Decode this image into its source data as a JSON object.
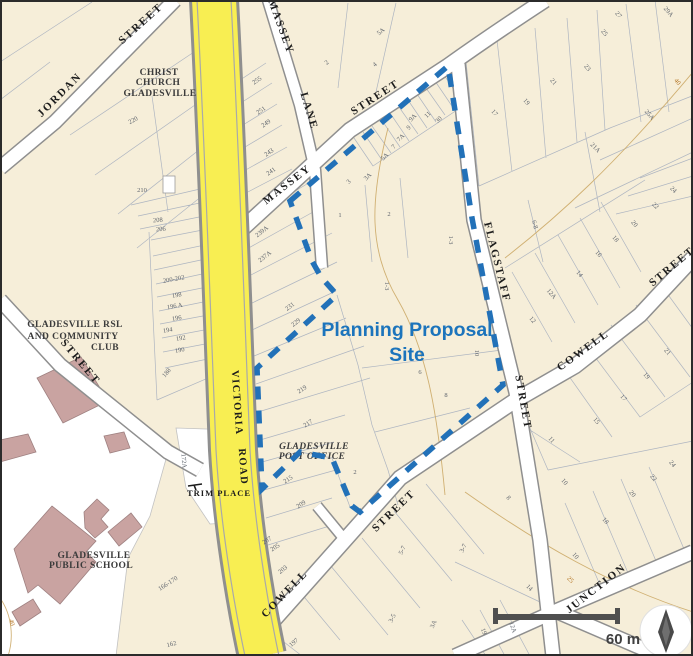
{
  "site": {
    "label_line1": "Planning Proposal",
    "label_line2": "Site"
  },
  "scale_bar": {
    "label": "60 m"
  },
  "streets": {
    "jordan": "JORDAN",
    "jordan_type": "STREET",
    "west_street": "STREET",
    "massey_lane": "MASSEY",
    "massey_lane_type": "LANE",
    "massey": "MASSEY",
    "massey_type": "STREET",
    "victoria": "VICTORIA",
    "victoria_type": "ROAD",
    "flagstaff": "FLAGSTAFF",
    "flagstaff_type": "STREET",
    "cowell_upper": "COWELL",
    "cowell_upper_type": "STREET",
    "cowell_lower": "COWELL",
    "cowell_lower_type": "STREET",
    "junction": "JUNCTION",
    "trim_place": "TRIM PLACE"
  },
  "places": {
    "church_l1": "CHRIST",
    "church_l2": "CHURCH",
    "church_l3": "GLADESVILLE",
    "rsl_l1": "GLADESVILLE RSL",
    "rsl_l2": "AND COMMUNITY",
    "rsl_l3": "CLUB",
    "school_l1": "GLADESVILLE",
    "school_l2": "PUBLIC SCHOOL",
    "post_office_l1": "GLADESVILLE",
    "post_office_l2": "POST OFFICE"
  },
  "colors": {
    "site_boundary": "#2271b8",
    "site_label": "#1c74bc",
    "road_yellow": "#f8ee52",
    "building_pink": "#c9a3a1",
    "background": "#f6eed9"
  },
  "lots": [
    "220",
    "210",
    "208",
    "206",
    "200-202",
    "198",
    "196 A",
    "196",
    "194",
    "192",
    "190",
    "188",
    "255",
    "251",
    "249",
    "243",
    "241",
    "2",
    "4",
    "5A",
    "11",
    "11",
    "30",
    "9A",
    "9",
    "7A",
    "7",
    "5A",
    "3A",
    "3",
    "17",
    "19",
    "21",
    "23",
    "25",
    "27",
    "29A",
    "25A",
    "21A",
    "24",
    "22",
    "40",
    "239A",
    "237A",
    "231",
    "229",
    "219",
    "217",
    "215",
    "209",
    "207",
    "205",
    "1",
    "2",
    "1-3",
    "1-3",
    "10",
    "6",
    "8",
    "2",
    "6-8",
    "20",
    "18",
    "16",
    "14",
    "12A",
    "12",
    "21",
    "19",
    "17",
    "15",
    "11",
    "10",
    "18",
    "20",
    "22",
    "24",
    "8",
    "10",
    "25",
    "14",
    "12A",
    "19",
    "3-7",
    "5-7",
    "3-5",
    "3A",
    "197",
    "203",
    "172A",
    "166-170",
    "162",
    "40"
  ]
}
